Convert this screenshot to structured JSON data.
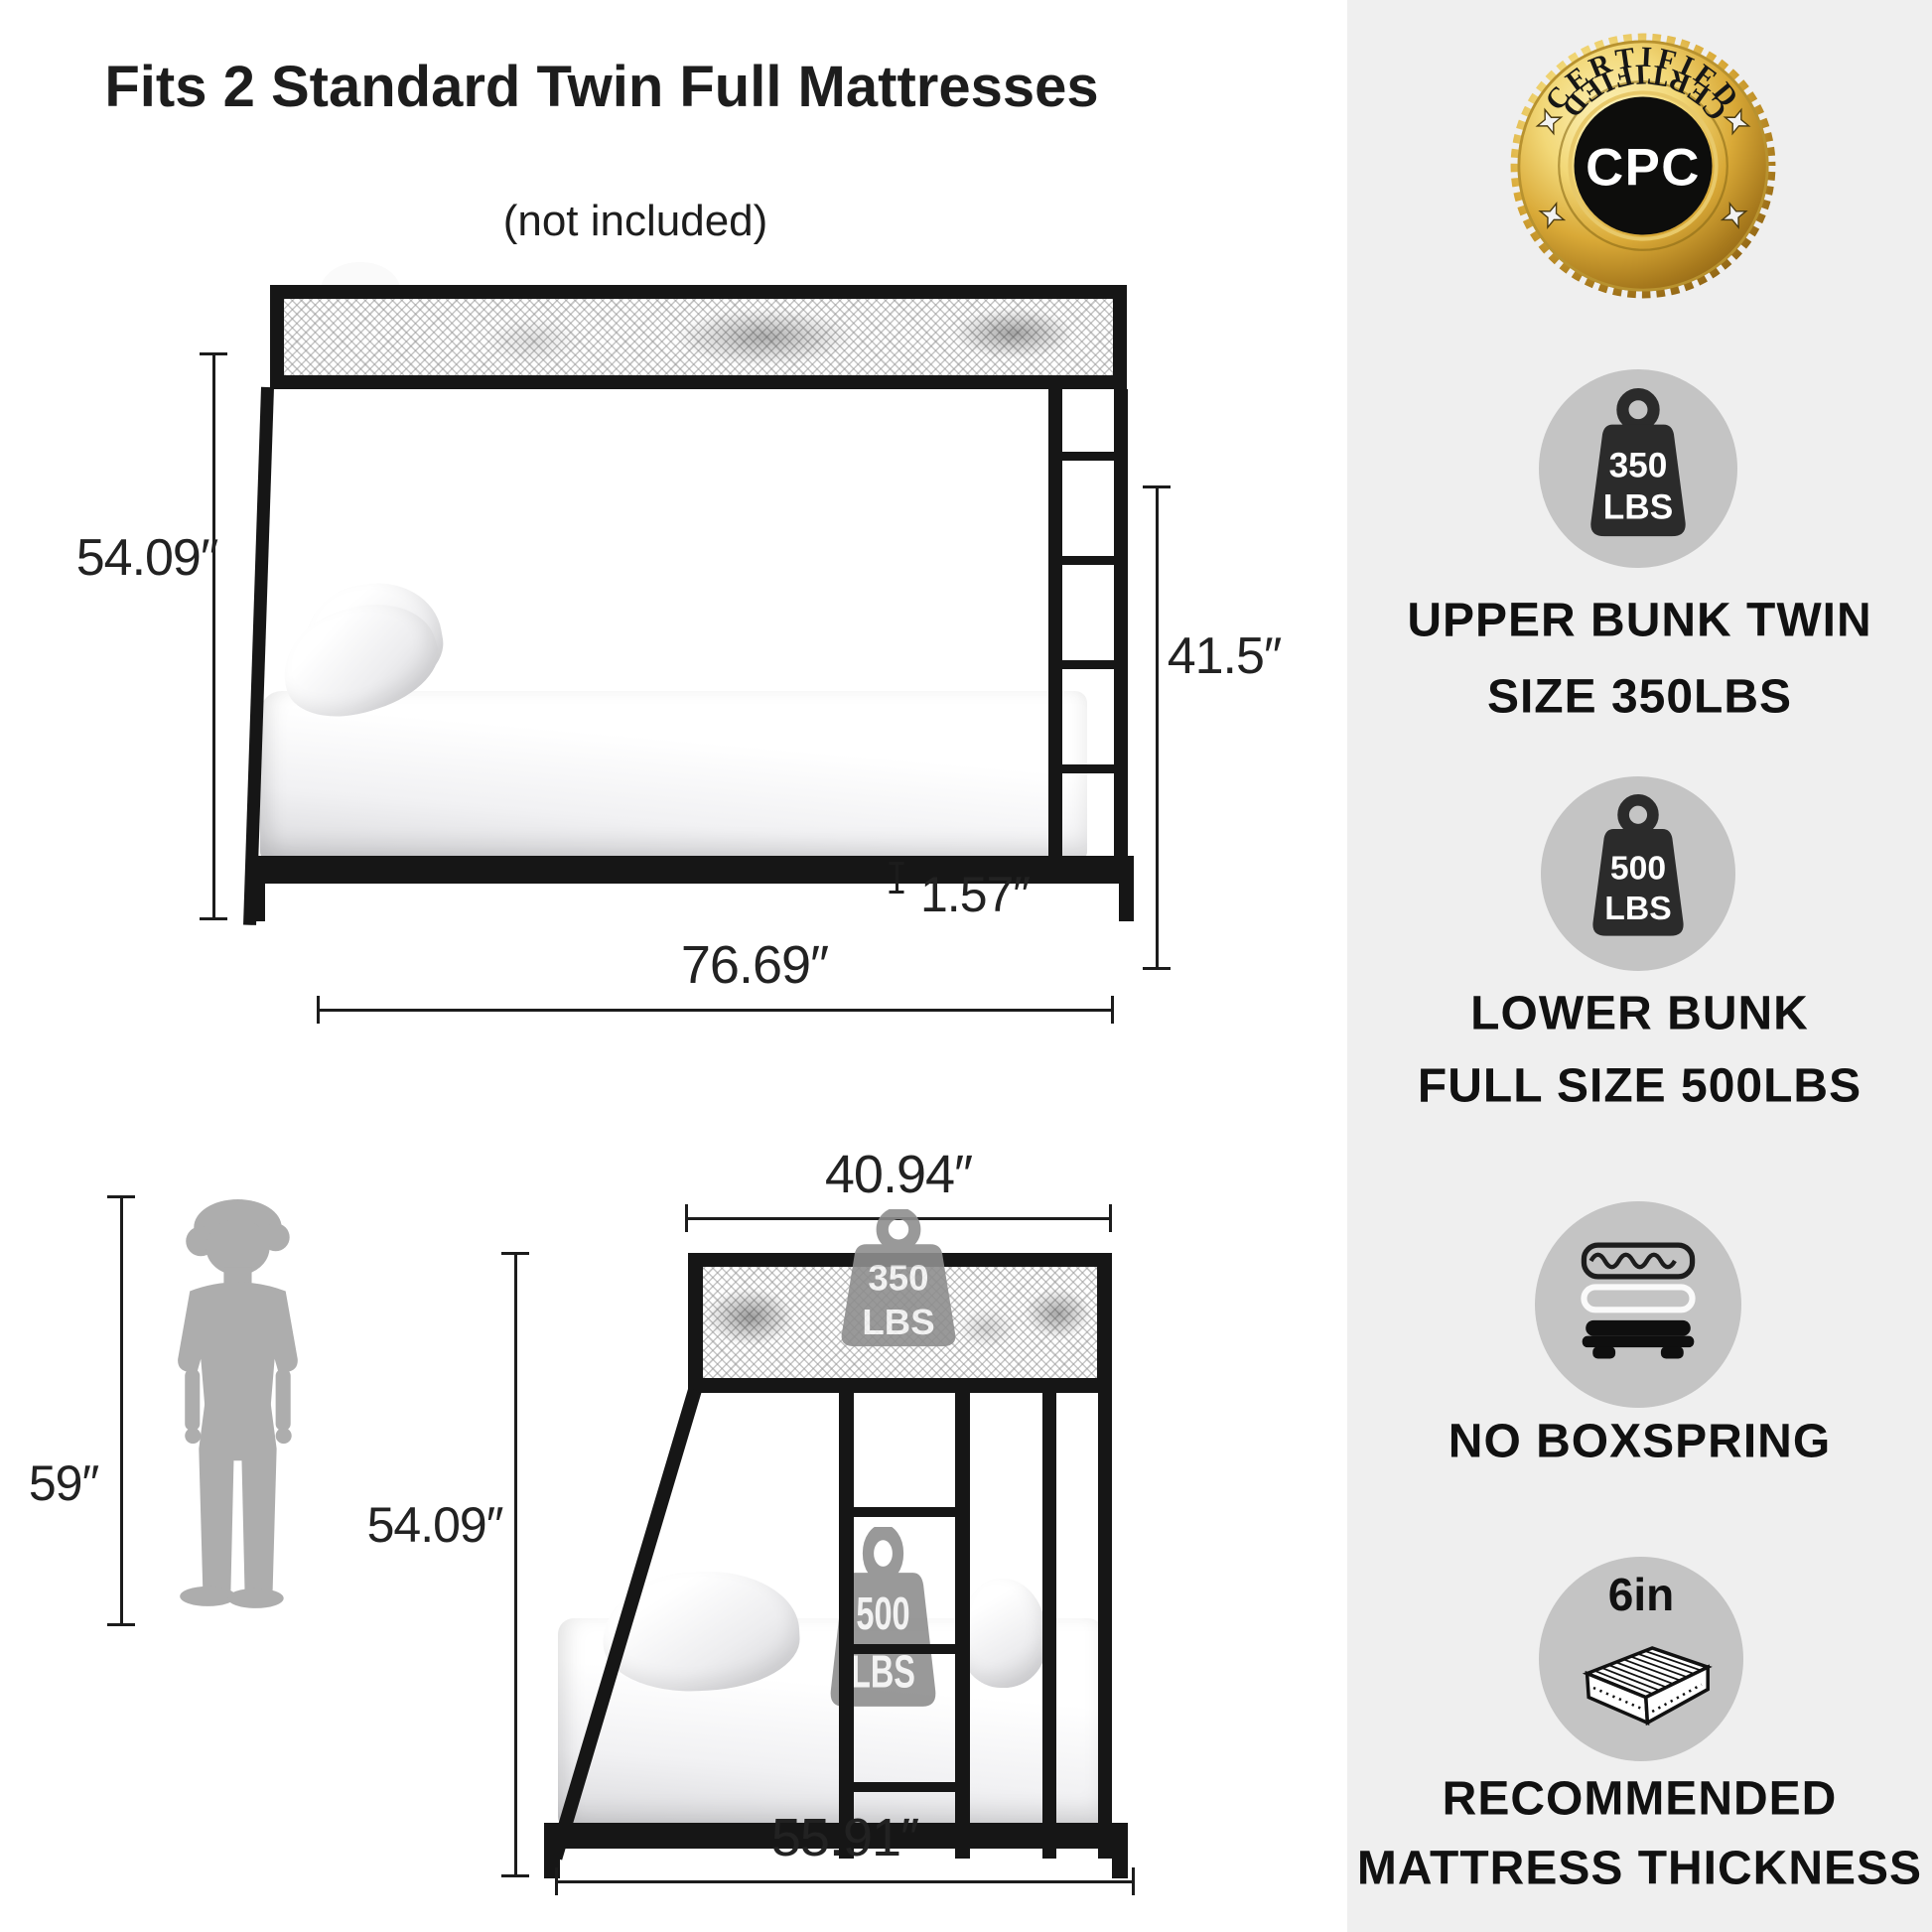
{
  "header": {
    "title": "Fits 2 Standard Twin Full Mattresses",
    "subtitle": "(not included)"
  },
  "badge": {
    "arc_top": "CERTIFIED",
    "arc_bottom": "CERTIFIED",
    "center": "CPC"
  },
  "side_view": {
    "height": "54.09″",
    "inner_height": "41.5″",
    "frame_thickness": "1.57″",
    "length": "76.69″"
  },
  "front_view": {
    "top_width": "40.94″",
    "height": "54.09″",
    "bottom_width": "55.91″",
    "upper_capacity": {
      "value": "350",
      "unit": "LBS"
    },
    "lower_capacity": {
      "value": "500",
      "unit": "LBS"
    }
  },
  "child": {
    "height": "59″"
  },
  "features": [
    {
      "icon": "weight-350-icon",
      "value": "350",
      "unit": "LBS",
      "lines": [
        "UPPER BUNK TWIN",
        "SIZE 350LBS"
      ]
    },
    {
      "icon": "weight-500-icon",
      "value": "500",
      "unit": "LBS",
      "lines": [
        "LOWER BUNK",
        "FULL SIZE 500LBS"
      ]
    },
    {
      "icon": "mattress-boxspring-icon",
      "lines": [
        "NO BOXSPRING"
      ]
    },
    {
      "icon": "mattress-3d-icon",
      "label": "6in",
      "lines": [
        "RECOMMENDED",
        "MATTRESS THICKNESS"
      ]
    }
  ],
  "colors": {
    "panel_bg": "#efefef",
    "frame_black": "#161616",
    "circle_gray": "#c4c4c4",
    "icon_dark": "#2b2b2b",
    "ghost_gray": "#8e8e8e",
    "silhouette_gray": "#adadad",
    "badge_gold": "#d9a937",
    "text": "#141414"
  }
}
